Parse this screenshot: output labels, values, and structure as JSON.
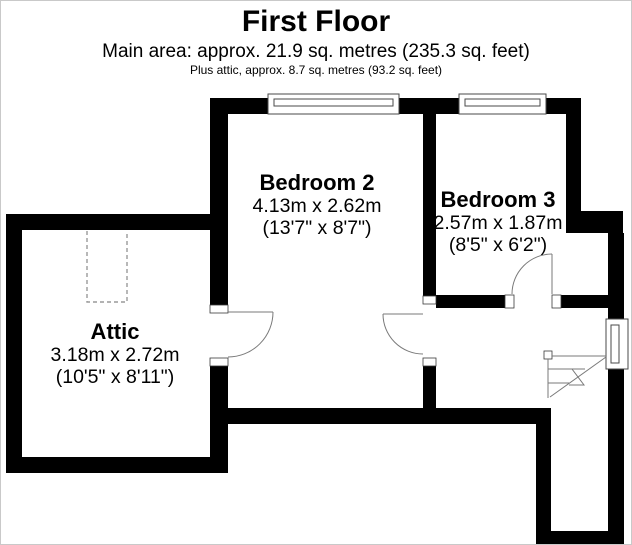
{
  "header": {
    "title": "First Floor",
    "main_area_line": "Main area: approx. 21.9 sq. metres (235.3 sq. feet)",
    "attic_area_line": "Plus attic, approx. 8.7 sq. metres (93.2 sq. feet)"
  },
  "rooms": {
    "bedroom2": {
      "name": "Bedroom 2",
      "metric": "4.13m x 2.62m",
      "imperial": "(13'7\" x 8'7\")"
    },
    "bedroom3": {
      "name": "Bedroom 3",
      "metric": "2.57m x 1.87m",
      "imperial": "(8'5\" x 6'2\")"
    },
    "attic": {
      "name": "Attic",
      "metric": "3.18m x 2.72m",
      "imperial": "(10'5\" x 8'11\")"
    }
  },
  "colors": {
    "wall": "#000000",
    "background": "#ffffff",
    "thin_line": "#7a7a7a",
    "dashed_line": "#9a9a9a"
  }
}
